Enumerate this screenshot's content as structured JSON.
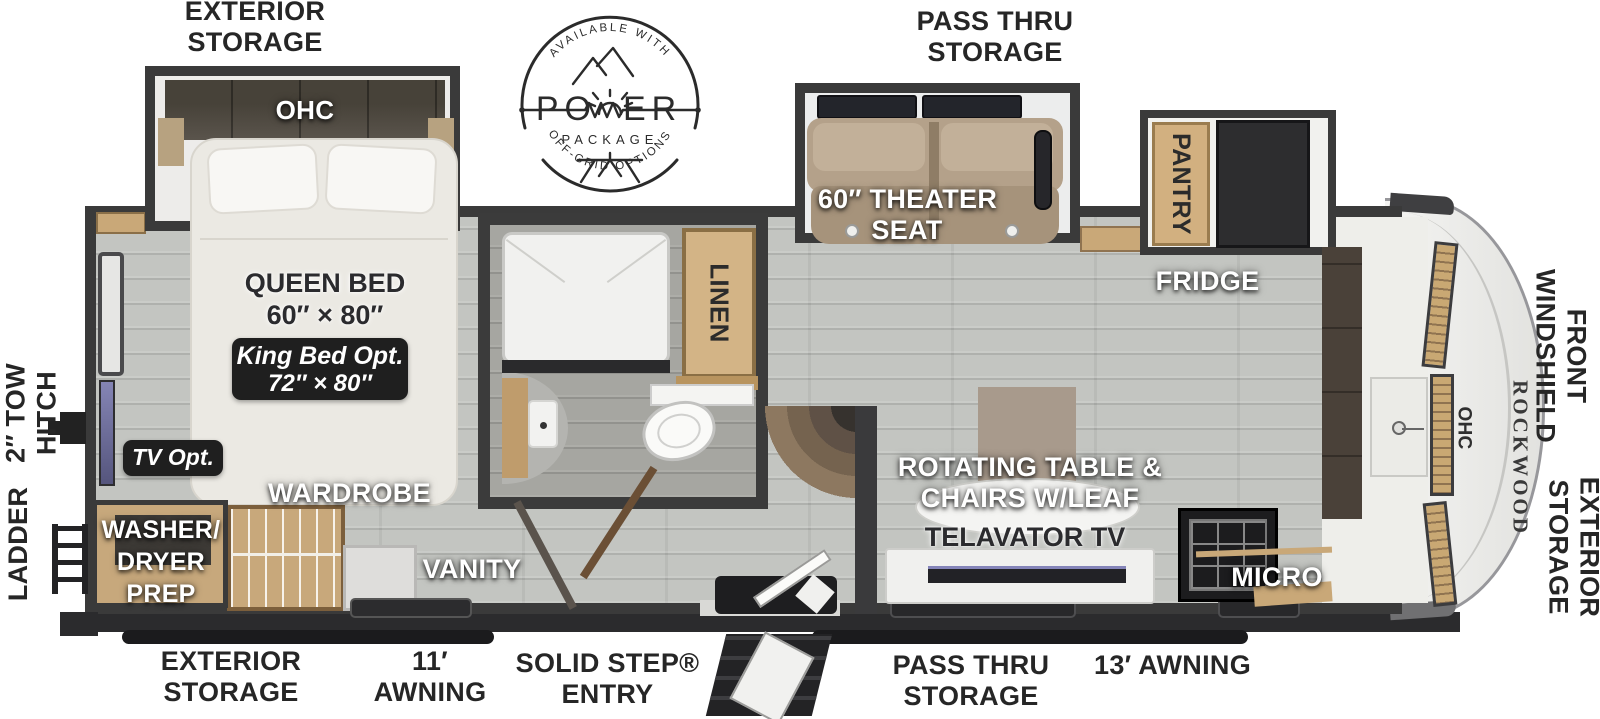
{
  "badge": {
    "available_with": "AVAILABLE WITH",
    "power_po": "PO",
    "power_er": "ER",
    "package": "PACKAGE",
    "off_grid": "OFF-GRID OPTIONS"
  },
  "outer_labels": {
    "exterior_storage_top_l1": "EXTERIOR",
    "exterior_storage_top_l2": "STORAGE",
    "pass_thru_top_l1": "PASS THRU",
    "pass_thru_top_l2": "STORAGE",
    "front_windshield_l1": "FRONT",
    "front_windshield_l2": "WINDSHIELD",
    "exterior_storage_right_l1": "EXTERIOR",
    "exterior_storage_right_l2": "STORAGE",
    "tow_hitch_l1": "2″ TOW",
    "tow_hitch_l2": "HITCH",
    "ladder": "LADDER",
    "exterior_storage_bottom_l1": "EXTERIOR",
    "exterior_storage_bottom_l2": "STORAGE",
    "awning_11_l1": "11′",
    "awning_11_l2": "AWNING",
    "solid_step_l1": "SOLID STEP®",
    "solid_step_l2": "ENTRY",
    "pass_thru_bottom_l1": "PASS THRU",
    "pass_thru_bottom_l2": "STORAGE",
    "awning_13": "13′ AWNING"
  },
  "rooms": {
    "bedroom": {
      "ohc": "OHC",
      "queen_l1": "QUEEN BED",
      "queen_l2": "60″ × 80″",
      "king_l1": "King Bed Opt.",
      "king_l2": "72″ × 80″",
      "tv_opt": "TV Opt.",
      "wardrobe": "WARDROBE",
      "washer_l1": "WASHER/",
      "washer_l2": "DRYER",
      "washer_l3": "PREP",
      "vanity": "VANITY"
    },
    "bathroom": {
      "linen": "LINEN"
    },
    "living": {
      "theater_l1": "60″ THEATER",
      "theater_l2": "SEAT",
      "pantry": "PANTRY",
      "fridge": "FRIDGE",
      "rotating_l1": "ROTATING TABLE &",
      "rotating_l2": "CHAIRS W/LEAF",
      "telavator": "TELAVATOR TV",
      "micro": "MICRO",
      "ohc_front": "OHC"
    },
    "brand": "ROCKWOOD"
  },
  "colors": {
    "wall": "#3a3a3a",
    "floor": "#c3c5c1",
    "bath_floor": "#a6a6a1",
    "cabinet_wood": "#c9a878",
    "dark_counter": "#4a4139",
    "theater_tan": "#b4a18a",
    "badge_bg": "#1f1f1f",
    "tv_screen": "#7070a0",
    "label_dark": "#262626"
  }
}
